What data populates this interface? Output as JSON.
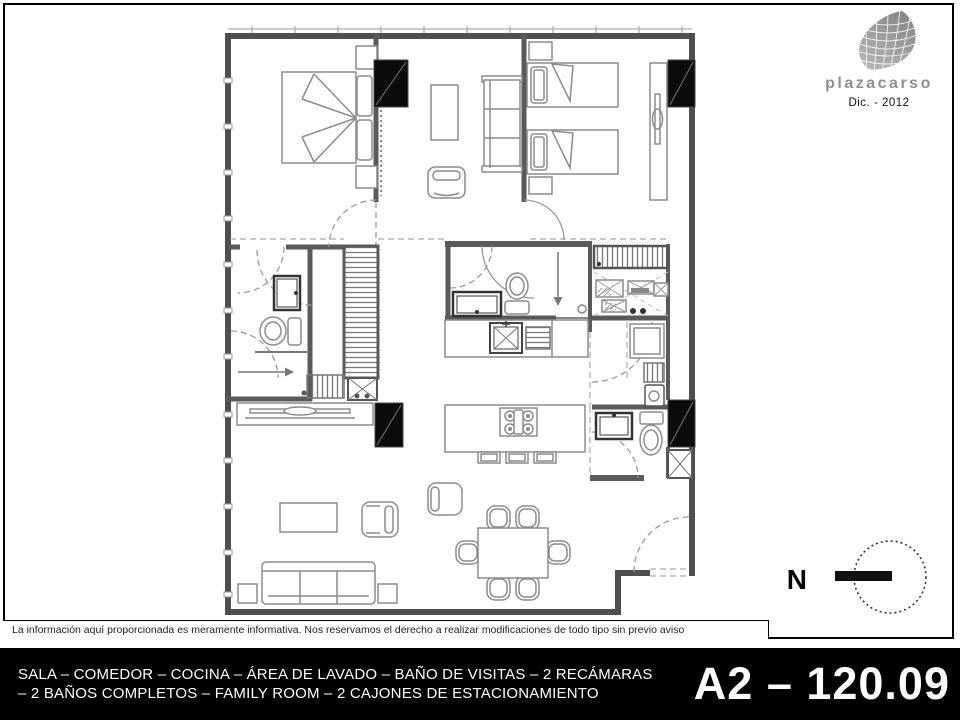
{
  "header": {
    "logo": {
      "wordmark": "plazacarso",
      "date": "Dic. - 2012",
      "mark_icon": "soumaya-building-icon",
      "wordmark_color": "#8f8f8f"
    }
  },
  "plan": {
    "wall_color": "#4f4f4f",
    "column_color": "#0b0b0b",
    "furniture_line_color": "#8c8c8c"
  },
  "compass": {
    "label": "N"
  },
  "disclaimer": {
    "text": "La información aquí proporcionada es meramente informativa. Nos reservamos el derecho a realizar modificaciones de todo tipo sin previo aviso"
  },
  "footer": {
    "summary_line1": "SALA – COMEDOR – COCINA – ÁREA DE LAVADO – BAÑO DE VISITAS – 2 RECÁMARAS",
    "summary_line2": "– 2 BAÑOS COMPLETOS – FAMILY ROOM – 2 CAJONES DE ESTACIONAMIENTO",
    "unit_code": "A2 – 120.09",
    "background": "#000000",
    "text_color": "#ffffff"
  }
}
